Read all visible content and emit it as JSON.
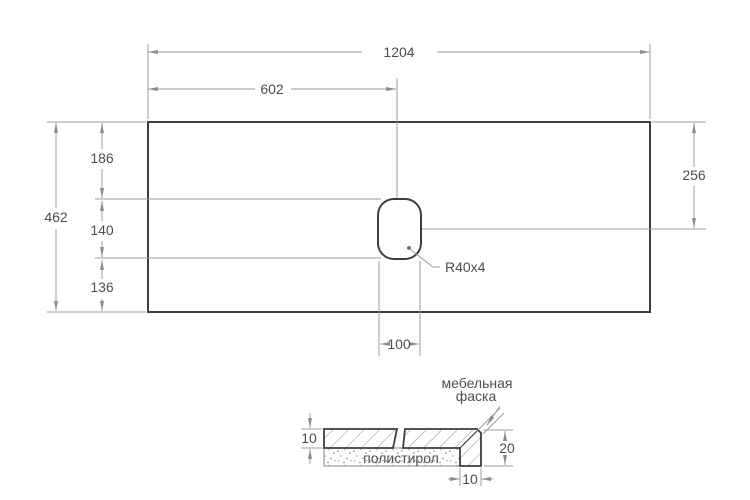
{
  "drawing_title": "countertop-dimension-drawing",
  "plan": {
    "overall_width": "1204",
    "center_offset": "602",
    "overall_depth": "462",
    "top_segment": "186",
    "middle_segment": "140",
    "bottom_segment": "136",
    "right_offset": "256",
    "cutout_width": "100",
    "corner_radius": "R40x4"
  },
  "section": {
    "top_thickness": "10",
    "edge_height": "20",
    "edge_width": "10",
    "filler": "полистирол",
    "chamfer_line1": "мебельная",
    "chamfer_line2": "фаска"
  },
  "colors": {
    "outline": "#3d3d3d",
    "dimension_lines": "#9c9c9c",
    "arrowheads": "#8c8c8c",
    "text": "#4d4d4d",
    "background": "#ffffff"
  }
}
